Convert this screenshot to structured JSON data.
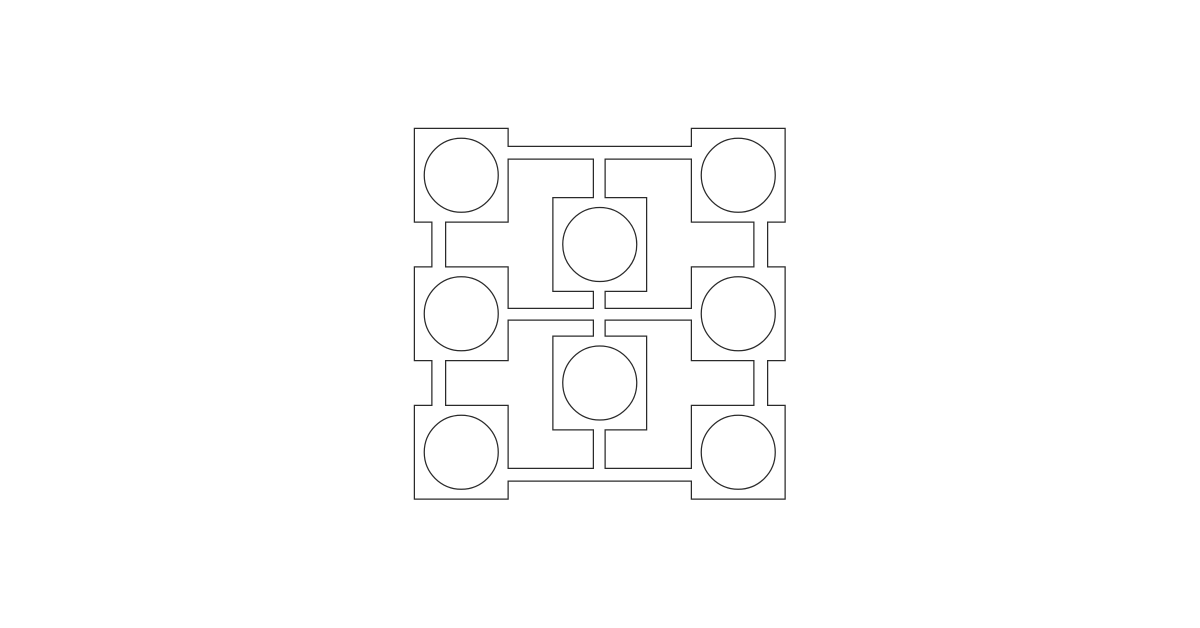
{
  "canvas": {
    "width": 1200,
    "height": 628,
    "background": "#ffffff"
  },
  "pattern": {
    "description": "ornamental outline pattern: eight squares with inscribed circles joined by narrow rectangular channels",
    "stroke_color": "#2a2a2a",
    "stroke_width": 1.25,
    "fill_color": "#ffffff",
    "circle_radius": 37,
    "rooms": [
      {
        "id": "room-top-left",
        "x": 415,
        "y": 129,
        "w": 92.5,
        "h": 92.5
      },
      {
        "id": "room-top-right",
        "x": 692,
        "y": 129,
        "w": 92.5,
        "h": 92.5
      },
      {
        "id": "room-middle-left",
        "x": 415,
        "y": 267.5,
        "w": 92.5,
        "h": 92.5
      },
      {
        "id": "room-middle-right",
        "x": 692,
        "y": 267.5,
        "w": 92.5,
        "h": 92.5
      },
      {
        "id": "room-bottom-left",
        "x": 415,
        "y": 406,
        "w": 92.5,
        "h": 92.5
      },
      {
        "id": "room-bottom-right",
        "x": 692,
        "y": 406,
        "w": 92.5,
        "h": 92.5
      },
      {
        "id": "room-center-top",
        "x": 553.5,
        "y": 198.25,
        "w": 92.5,
        "h": 92.5
      },
      {
        "id": "room-center-bottom",
        "x": 553.5,
        "y": 336.75,
        "w": 92.5,
        "h": 92.5
      }
    ],
    "channels": [
      {
        "id": "channel-top",
        "x": 461,
        "y": 147,
        "w": 277,
        "h": 11.5
      },
      {
        "id": "channel-bottom",
        "x": 461,
        "y": 469,
        "w": 277,
        "h": 11.5
      },
      {
        "id": "channel-middle",
        "x": 461,
        "y": 309,
        "w": 277,
        "h": 10.5
      },
      {
        "id": "channel-left-vertical",
        "x": 432.5,
        "y": 175,
        "w": 12.5,
        "h": 277
      },
      {
        "id": "channel-right-vertical",
        "x": 754.5,
        "y": 175,
        "w": 12.5,
        "h": 277
      },
      {
        "id": "channel-center-vertical",
        "x": 594,
        "y": 152,
        "w": 10.5,
        "h": 323
      }
    ],
    "circles": [
      {
        "id": "circle-top-left",
        "cx": 461.25,
        "cy": 175.25
      },
      {
        "id": "circle-top-right",
        "cx": 738.25,
        "cy": 175.25
      },
      {
        "id": "circle-middle-left",
        "cx": 461.25,
        "cy": 313.75
      },
      {
        "id": "circle-middle-right",
        "cx": 738.25,
        "cy": 313.75
      },
      {
        "id": "circle-bottom-left",
        "cx": 461.25,
        "cy": 452.25
      },
      {
        "id": "circle-bottom-right",
        "cx": 738.25,
        "cy": 452.25
      },
      {
        "id": "circle-center-top",
        "cx": 599.75,
        "cy": 244.5
      },
      {
        "id": "circle-center-bottom",
        "cx": 599.75,
        "cy": 383
      }
    ]
  }
}
